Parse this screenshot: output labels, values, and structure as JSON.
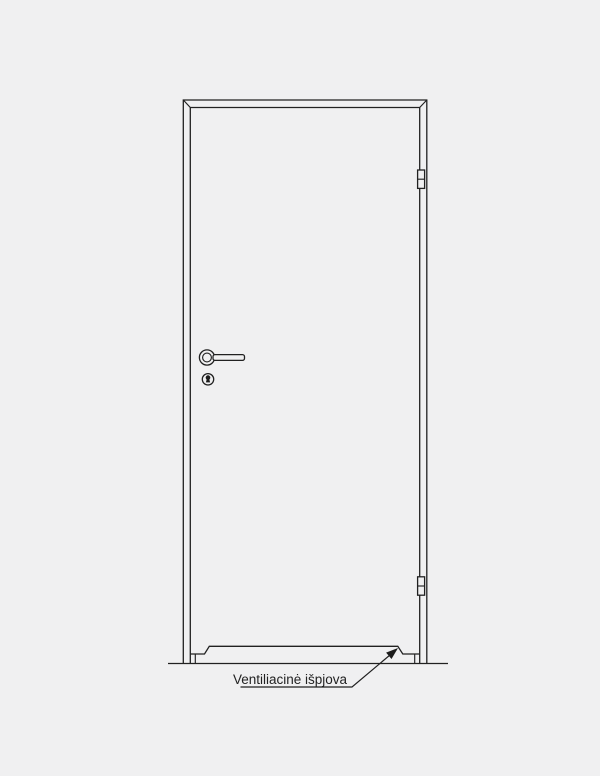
{
  "page": {
    "background_color": "#f0f0f1",
    "line_color": "#212121"
  },
  "annotation": {
    "label": "Ventiliacinė išpjova"
  },
  "diagram": {
    "type": "technical-line-drawing",
    "subject": "door-elevation",
    "hinge_count": 2,
    "parts": [
      "door-frame",
      "door-leaf",
      "hinge-top",
      "hinge-bottom",
      "lever-handle",
      "keyhole-escutcheon",
      "floor-line",
      "ventilation-cutout"
    ]
  }
}
